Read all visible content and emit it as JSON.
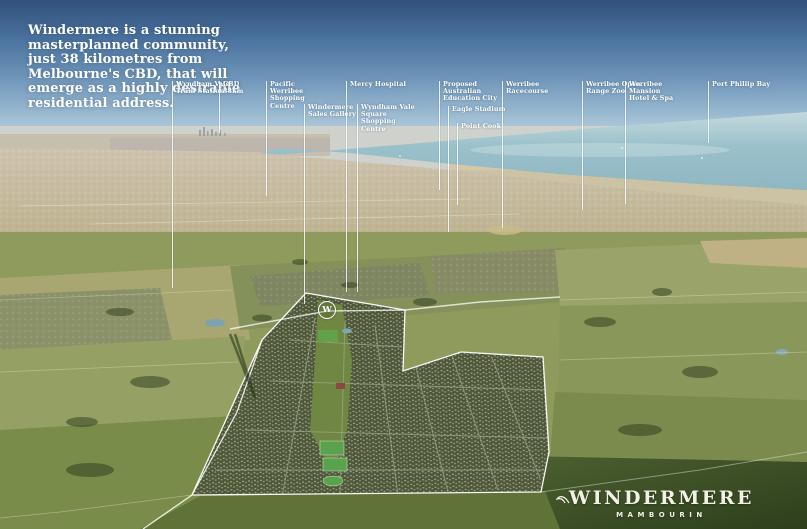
{
  "headline": {
    "text": "Windermere is a stunning masterplanned community,\njust 38 kilometres from Melbourne's CBD, that will\nemerge as a highly desirable residential address."
  },
  "labels": [
    {
      "id": "wyndham-vale-train-station",
      "text": "Wyndham Vale\nTrain Station"
    },
    {
      "id": "cbd-38km",
      "text": "CBD\n38km"
    },
    {
      "id": "pacific-werribee-shopping-centre",
      "text": "Pacific Werribee\nShopping Centre"
    },
    {
      "id": "windermere-sales-gallery",
      "text": "Windermere\nSales Gallery"
    },
    {
      "id": "mercy-hospital",
      "text": "Mercy Hospital"
    },
    {
      "id": "wyndham-vale-square-shopping-centre",
      "text": "Wyndham Vale\nSquare Shopping\nCentre"
    },
    {
      "id": "proposed-australian-education-city",
      "text": "Proposed Australian\nEducation City"
    },
    {
      "id": "eagle-stadium",
      "text": "Eagle Stadium"
    },
    {
      "id": "point-cook",
      "text": "Point Cook"
    },
    {
      "id": "werribee-racecourse",
      "text": "Werribee\nRacecourse"
    },
    {
      "id": "werribee-open-range-zoo",
      "text": "Werribee Open\nRange Zoo"
    },
    {
      "id": "werribee-mansion-hotel-spa",
      "text": "Werribee Mansion\nHotel & Spa"
    },
    {
      "id": "port-phillip-bay",
      "text": "Port Phillip Bay"
    }
  ],
  "site_marker": {
    "letter": "W"
  },
  "logo": {
    "name": "WINDERMERE",
    "location": "MAMBOURIN"
  },
  "colors": {
    "sky_top": "#31507a",
    "sky_horizon": "#dee6e7",
    "bay_water": "#8fb7c2",
    "distant_urban": "#c8bca8",
    "field_olive": "#9aa265",
    "foreground_green": "#5f7338",
    "estate_boundary": "#ffffff",
    "label_text": "#ffffff"
  }
}
